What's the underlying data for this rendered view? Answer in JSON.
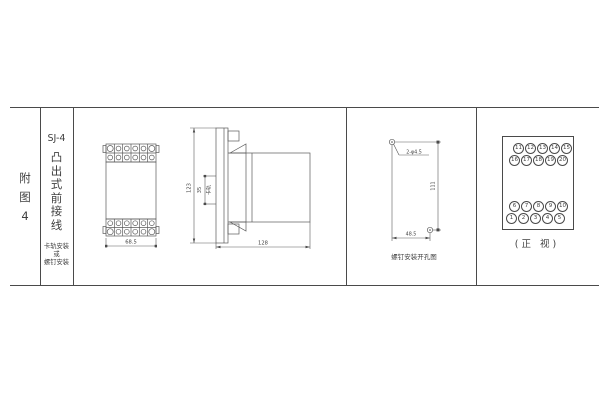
{
  "colors": {
    "line": "#4a4a4a",
    "background": "#ffffff"
  },
  "index_column": {
    "lines": [
      "附",
      "图",
      "4"
    ]
  },
  "title_column": {
    "model": "SJ-4",
    "style_vertical": "凸出式前接线",
    "note_lines": [
      "卡轨安装",
      "或",
      "螺钉安装"
    ]
  },
  "front_view": {
    "width_dim": "68.5"
  },
  "side_view": {
    "height_dim": "123",
    "depth_dim": "128",
    "rail_dim": "35",
    "rail_label": "卡轨"
  },
  "drill_view": {
    "holes_label": "2-φ4.5",
    "height_dim": "111",
    "width_dim": "48.5",
    "caption": "螺钉安装开孔图"
  },
  "terminal_view": {
    "caption": "(正 视)",
    "rows": [
      [
        "11",
        "12",
        "13",
        "14",
        "15"
      ],
      [
        "16",
        "17",
        "18",
        "19",
        "20"
      ],
      [
        "6",
        "7",
        "8",
        "9",
        "10"
      ],
      [
        "1",
        "2",
        "3",
        "4",
        "5"
      ]
    ]
  }
}
